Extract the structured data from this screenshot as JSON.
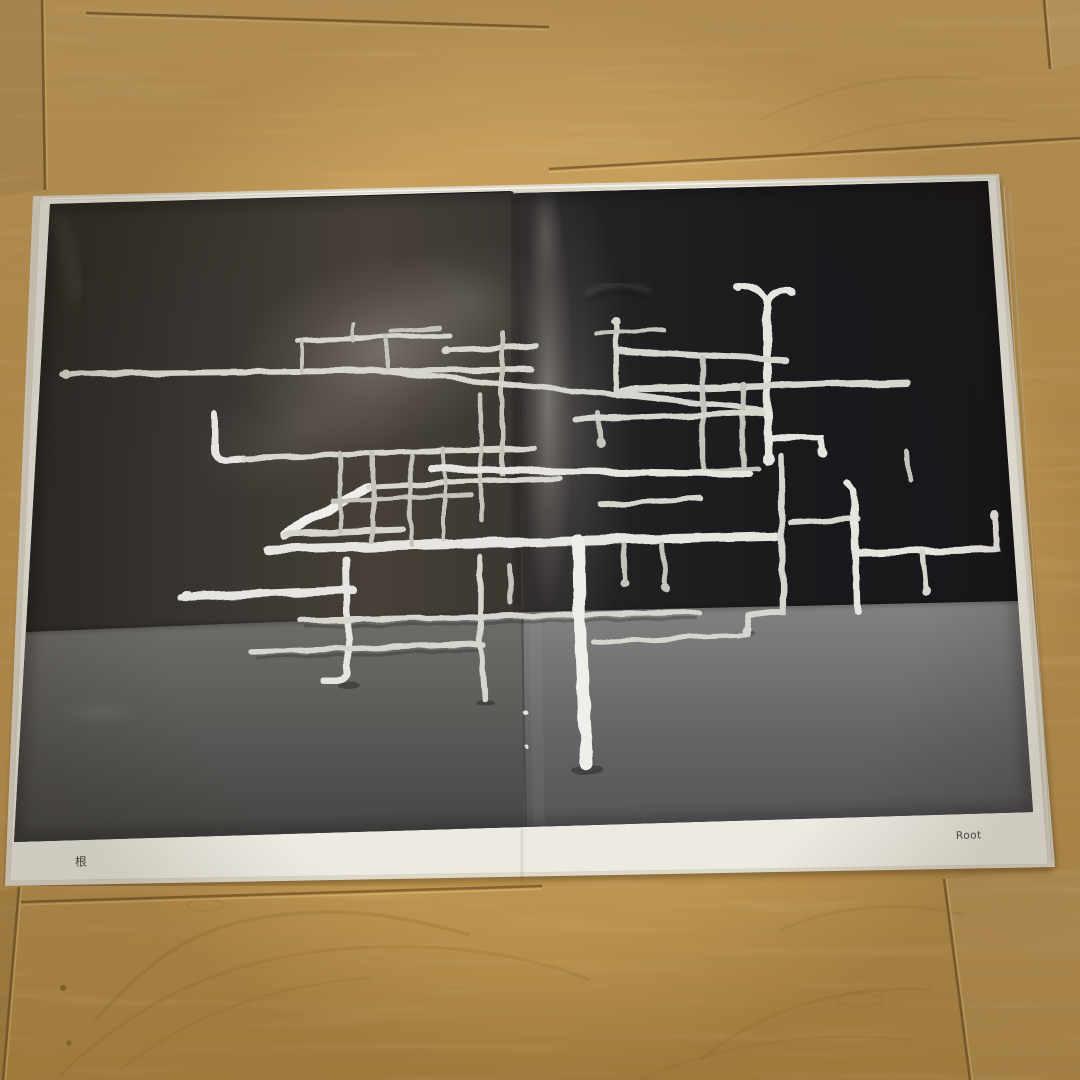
{
  "scene": {
    "description": "Photograph of an open exhibition-catalog spread lying on an oak wood floor; the spread is a full-bleed black-and-white photo of an abstract welded-rod sculpture standing on a studio floor",
    "book": {
      "left_page": {
        "caption": "根"
      },
      "right_page": {
        "caption": "Root"
      }
    }
  },
  "colors": {
    "wood_base": "#c2964e",
    "wood_seam": "#7d5b2b",
    "wood_seam_highlight": "#e3c07b",
    "page_white": "#edeae1",
    "page_edge_stack": "#ded8c9",
    "photo_black": "#1c1b1d",
    "photo_floor_gray": "#6e6d69",
    "sculpture_white": "#d8d7d0",
    "caption_color": "#4c4c4c"
  }
}
